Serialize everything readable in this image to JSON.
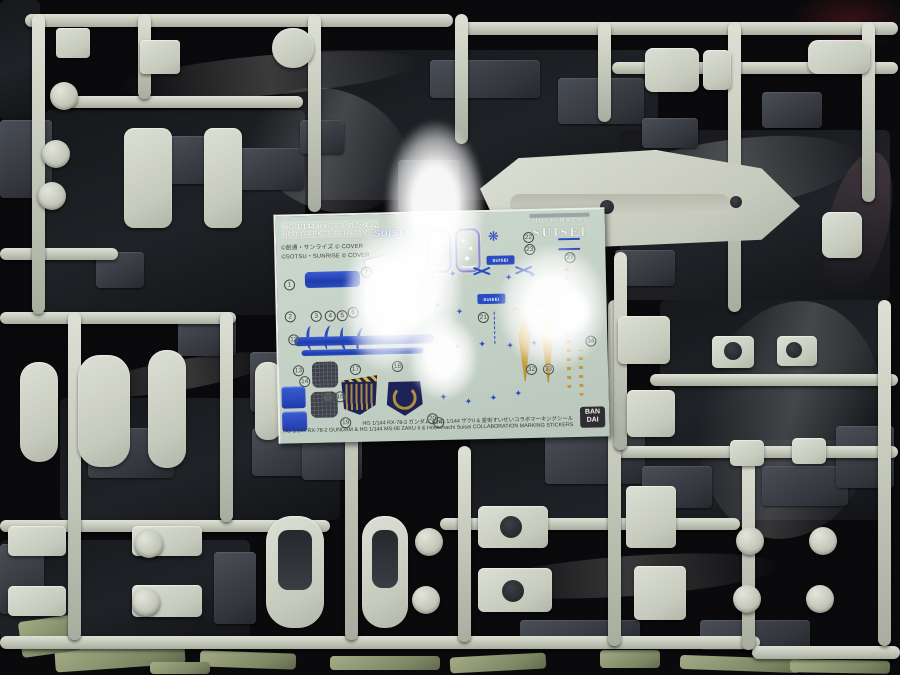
{
  "image": {
    "type": "photograph",
    "subject": "Gundam HG model kit sprues in plastic wrap with collaboration marking sticker sheet on top"
  },
  "sticker_sheet": {
    "header": {
      "title_jp": "HG 1/144 RX-78-2 ガンダム",
      "title_en": "HG 1/144 RX-78-2 GUNDAM",
      "copyright_line1": "©創通・サンライズ  © COVER",
      "copyright_line2": "©SOTSU・SUNRISE  © COVER"
    },
    "logo": {
      "line1": "HOSHIMACHI",
      "line2": "SUISEI"
    },
    "script_logo": "SUISEI",
    "suisei_badge1": "SUISEI",
    "suisei_badge2": "SUISEI",
    "footer_jp": "HG 1/144 RX-78-2 ガンダム & HG 1/144 ザクII & 星街すいせいコラボマーキングシール",
    "footer_en": "HG 1/144 RX-78-2 GUNDAM & HG 1/144 MS-06 ZAKU II & Hoshimachi Suisei COLLABORATION MARKING STICKERS",
    "bandai_line1": "BAN",
    "bandai_line2": "DAI",
    "numbers": [
      "1",
      "2",
      "3",
      "4",
      "5",
      "6",
      "7",
      "12",
      "13",
      "14",
      "15",
      "16",
      "17",
      "18",
      "19",
      "20",
      "21",
      "22",
      "23",
      "24",
      "27",
      "28",
      "32",
      "33",
      "34"
    ]
  },
  "colors": {
    "sprue_light": "#cdd1c5",
    "sprue_dark": "#3a3d43",
    "sprue_green": "#949d79",
    "sheet_background": "#c6d2c7",
    "sticker_blue": "#2a4cc0",
    "sticker_gold": "#c19a3e",
    "emblem_navy": "#1d2357",
    "star_panel_purple": "#8d84d8",
    "bandai_box": "#302d32",
    "background": "#0a0a0c"
  }
}
